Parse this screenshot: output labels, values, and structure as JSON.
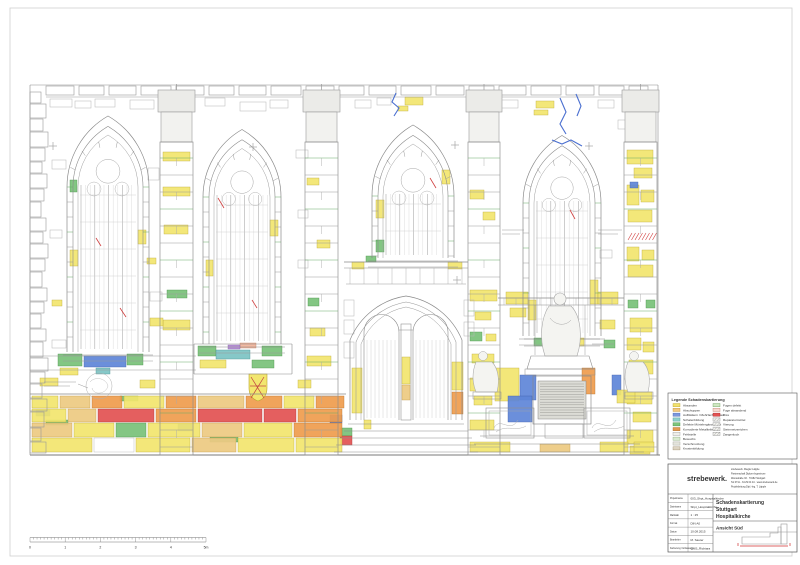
{
  "sheet": {
    "background": "#ffffff",
    "border_color": "#c9c9c9"
  },
  "legend": {
    "title": "Legende Schadenskartierung",
    "columns": [
      {
        "items": [
          {
            "label": "Absanden",
            "color": "#f1e26e",
            "outline": "#b9a42e"
          },
          {
            "label": "Abschuppen",
            "color": "#f3c97e",
            "outline": "#bf9440"
          },
          {
            "label": "Aufblättern / Mehrfachschalen",
            "color": "#7b97dc",
            "outline": "#4a66b0"
          },
          {
            "label": "Schalenbildung",
            "color": "#8fd0cc",
            "outline": "#4a9a96"
          },
          {
            "label": "Defekte Mörtelergänzungen",
            "color": "#7cc47c",
            "outline": "#3f8f3f"
          },
          {
            "label": "Korrodierte Metallteile",
            "color": "#e29a50",
            "outline": "#a86a28"
          },
          {
            "label": "Fehlstelle",
            "color": "#efefe9",
            "outline": "#999999"
          },
          {
            "label": "Bewuchs",
            "color": "#d9ead0",
            "outline": "#8aa87a"
          },
          {
            "label": "Verschmutzung",
            "color": "#e4e4dc",
            "outline": "#a0a095"
          },
          {
            "label": "Krustenbildung",
            "color": "#ddd4c2",
            "outline": "#a09070"
          }
        ]
      },
      {
        "items": [
          {
            "label": "Fugen defekt",
            "color": "#cfe7c2",
            "outline": "#6aa05a"
          },
          {
            "label": "Fuge absandend",
            "color": "#f6d9cf",
            "outline": "#c08070"
          },
          {
            "label": "Riss",
            "color": "#e25252",
            "outline": "#a82828"
          },
          {
            "label": "Reparaturmörtel",
            "color": "#f2f2ee",
            "outline": "#888888",
            "hatch": true
          },
          {
            "label": "Vierung",
            "color": "#f2f2ee",
            "outline": "#888888",
            "hatch": true
          },
          {
            "label": "Steinmetzzeichen",
            "color": "#f2f2ee",
            "outline": "#888888",
            "hatch": true
          },
          {
            "label": "Zangenloch",
            "color": "#f2f2ee",
            "outline": "#888888",
            "hatch": true
          }
        ]
      }
    ]
  },
  "title_block": {
    "logo": "strebewerk.",
    "logo_color": "#c41828",
    "address_lines": [
      "strebewerk. Riegler Läpple",
      "Partnerschaft Diplom-Ingenieure",
      "Werastraße 33 · 70182 Stuttgart",
      "Tel 0711 - 34 29 04 44 · www.strebewerk.de",
      "Projektleitung Dipl.-Ing. T. Läpple"
    ],
    "fields": [
      {
        "label": "Projektname",
        "value": "003_Shpt_Hospitalkirche"
      },
      {
        "label": "Dateiname",
        "value": "Shpt_Hospitalkirche"
      },
      {
        "label": "Maßstab",
        "value": "1 : 25"
      },
      {
        "label": "Format",
        "value": "DIN A0"
      },
      {
        "label": "Datum",
        "value": "10.08.2015"
      },
      {
        "label": "Bearbeiter",
        "value": "M. Sauter"
      },
      {
        "label": "Kartierung / Erfassung",
        "value": "QMS_Richtara"
      }
    ],
    "project_title_lines": [
      "Schadenskartierung",
      "Stuttgart",
      "Hospitalkirche"
    ],
    "view_label": "Ansicht Süd"
  },
  "scale_bar": {
    "labels": [
      "0",
      "1",
      "2",
      "3",
      "4",
      "5m"
    ]
  },
  "drawing": {
    "palette": {
      "Y": "#f2e66e",
      "T": "#edca82",
      "O": "#ef9d4e",
      "R": "#e25252",
      "G": "#79c279",
      "B": "#5f86d8",
      "C": "#7cc4c4",
      "W": "#ffffff",
      "S": "#f2b49a",
      "P": "#b58cd6"
    },
    "outlines": {
      "Y": "#b9a42e",
      "T": "#bf9440",
      "O": "#b56a20",
      "R": "#a82828",
      "G": "#3f8f3f",
      "B": "#3a5aa8",
      "C": "#3f908f",
      "W": "#aaaaaa",
      "S": "#c07858",
      "P": "#7e55a8"
    },
    "patches": [
      [
        405,
        97,
        18,
        8,
        "Y"
      ],
      [
        398,
        106,
        10,
        5,
        "Y"
      ],
      [
        536,
        101,
        18,
        7,
        "Y"
      ],
      [
        534,
        110,
        14,
        5,
        "Y"
      ],
      [
        163,
        152,
        27,
        9,
        "Y"
      ],
      [
        163,
        187,
        27,
        9,
        "Y"
      ],
      [
        164,
        225,
        24,
        9,
        "Y"
      ],
      [
        167,
        290,
        20,
        8,
        "G"
      ],
      [
        163,
        320,
        27,
        10,
        "Y"
      ],
      [
        307,
        178,
        12,
        7,
        "Y"
      ],
      [
        317,
        240,
        13,
        8,
        "Y"
      ],
      [
        308,
        298,
        11,
        8,
        "G"
      ],
      [
        310,
        328,
        15,
        8,
        "Y"
      ],
      [
        307,
        356,
        24,
        10,
        "Y"
      ],
      [
        470,
        190,
        14,
        9,
        "Y"
      ],
      [
        483,
        212,
        12,
        8,
        "Y"
      ],
      [
        470,
        290,
        27,
        11,
        "Y"
      ],
      [
        475,
        312,
        16,
        8,
        "Y"
      ],
      [
        470,
        332,
        12,
        9,
        "G"
      ],
      [
        486,
        334,
        10,
        7,
        "Y"
      ],
      [
        472,
        354,
        22,
        9,
        "Y"
      ],
      [
        470,
        378,
        27,
        13,
        "Y"
      ],
      [
        474,
        396,
        18,
        9,
        "Y"
      ],
      [
        470,
        420,
        24,
        10,
        "Y"
      ],
      [
        627,
        150,
        26,
        14,
        "Y"
      ],
      [
        634,
        168,
        18,
        10,
        "Y"
      ],
      [
        627,
        185,
        12,
        20,
        "Y"
      ],
      [
        641,
        190,
        13,
        12,
        "Y"
      ],
      [
        628,
        210,
        24,
        12,
        "Y"
      ],
      [
        630,
        182,
        8,
        6,
        "B"
      ],
      [
        627,
        247,
        12,
        14,
        "Y"
      ],
      [
        642,
        250,
        12,
        10,
        "Y"
      ],
      [
        628,
        265,
        25,
        12,
        "Y"
      ],
      [
        646,
        300,
        9,
        8,
        "G"
      ],
      [
        628,
        300,
        10,
        8,
        "G"
      ],
      [
        630,
        318,
        22,
        14,
        "Y"
      ],
      [
        627,
        338,
        14,
        12,
        "Y"
      ],
      [
        643,
        342,
        11,
        10,
        "Y"
      ],
      [
        629,
        360,
        24,
        14,
        "Y"
      ],
      [
        627,
        392,
        25,
        12,
        "Y"
      ],
      [
        633,
        412,
        18,
        10,
        "Y"
      ],
      [
        627,
        430,
        26,
        14,
        "Y"
      ],
      [
        630,
        446,
        20,
        8,
        "Y"
      ],
      [
        70,
        250,
        8,
        16,
        "Y"
      ],
      [
        138,
        230,
        8,
        14,
        "Y"
      ],
      [
        70,
        180,
        7,
        12,
        "G"
      ],
      [
        206,
        260,
        7,
        16,
        "Y"
      ],
      [
        270,
        220,
        8,
        16,
        "Y"
      ],
      [
        376,
        200,
        8,
        18,
        "Y"
      ],
      [
        442,
        170,
        8,
        14,
        "Y"
      ],
      [
        376,
        240,
        8,
        12,
        "G"
      ],
      [
        528,
        300,
        8,
        20,
        "Y"
      ],
      [
        590,
        280,
        8,
        24,
        "Y"
      ],
      [
        58,
        354,
        24,
        12,
        "G"
      ],
      [
        84,
        356,
        42,
        11,
        "B"
      ],
      [
        127,
        354,
        16,
        11,
        "G"
      ],
      [
        60,
        368,
        18,
        7,
        "Y"
      ],
      [
        96,
        368,
        14,
        6,
        "C"
      ],
      [
        198,
        346,
        18,
        10,
        "G"
      ],
      [
        216,
        350,
        34,
        9,
        "C"
      ],
      [
        262,
        346,
        20,
        10,
        "G"
      ],
      [
        200,
        360,
        26,
        8,
        "Y"
      ],
      [
        252,
        360,
        22,
        8,
        "G"
      ],
      [
        240,
        343,
        16,
        5,
        "S"
      ],
      [
        228,
        345,
        12,
        4,
        "P"
      ],
      [
        534,
        338,
        18,
        8,
        "G"
      ],
      [
        566,
        338,
        18,
        8,
        "Y"
      ],
      [
        352,
        262,
        12,
        7,
        "Y"
      ],
      [
        448,
        262,
        14,
        7,
        "Y"
      ],
      [
        366,
        256,
        10,
        6,
        "G"
      ],
      [
        352,
        368,
        10,
        45,
        "Y"
      ],
      [
        452,
        362,
        11,
        28,
        "Y"
      ],
      [
        452,
        392,
        11,
        22,
        "O"
      ],
      [
        340,
        428,
        12,
        8,
        "G"
      ],
      [
        340,
        436,
        12,
        9,
        "R"
      ],
      [
        402,
        357,
        8,
        27,
        "Y"
      ],
      [
        402,
        385,
        8,
        15,
        "T"
      ],
      [
        364,
        420,
        7,
        9,
        "Y"
      ],
      [
        506,
        292,
        22,
        12,
        "Y"
      ],
      [
        510,
        308,
        16,
        9,
        "Y"
      ],
      [
        495,
        368,
        24,
        33,
        "Y"
      ],
      [
        520,
        375,
        16,
        25,
        "B"
      ],
      [
        508,
        396,
        24,
        26,
        "B"
      ],
      [
        582,
        368,
        13,
        26,
        "O"
      ],
      [
        612,
        375,
        9,
        20,
        "B"
      ],
      [
        598,
        292,
        20,
        12,
        "Y"
      ],
      [
        600,
        320,
        15,
        9,
        "Y"
      ],
      [
        604,
        340,
        11,
        8,
        "G"
      ],
      [
        617,
        390,
        18,
        13,
        "Y"
      ],
      [
        150,
        318,
        13,
        8,
        "Y"
      ],
      [
        52,
        300,
        10,
        6,
        "Y"
      ],
      [
        147,
        258,
        9,
        6,
        "Y"
      ],
      [
        40,
        378,
        18,
        8,
        "Y"
      ],
      [
        140,
        380,
        15,
        8,
        "Y"
      ],
      [
        298,
        380,
        13,
        8,
        "Y"
      ],
      [
        330,
        415,
        12,
        8,
        "B"
      ],
      [
        36,
        410,
        14,
        6,
        "B"
      ],
      [
        178,
        424,
        14,
        7,
        "B"
      ],
      [
        46,
        420,
        22,
        5,
        "G"
      ],
      [
        210,
        437,
        28,
        5,
        "G"
      ],
      [
        120,
        396,
        18,
        5,
        "G"
      ],
      [
        32,
        396,
        26,
        12,
        "Y"
      ],
      [
        60,
        396,
        30,
        12,
        "T"
      ],
      [
        92,
        396,
        30,
        12,
        "O"
      ],
      [
        124,
        396,
        40,
        12,
        "Y"
      ],
      [
        166,
        396,
        30,
        12,
        "O"
      ],
      [
        198,
        396,
        46,
        12,
        "T"
      ],
      [
        246,
        396,
        36,
        12,
        "O"
      ],
      [
        284,
        396,
        30,
        12,
        "Y"
      ],
      [
        316,
        396,
        28,
        12,
        "O"
      ],
      [
        32,
        409,
        34,
        13,
        "Y"
      ],
      [
        68,
        409,
        28,
        13,
        "T"
      ],
      [
        98,
        409,
        56,
        13,
        "R"
      ],
      [
        156,
        409,
        40,
        13,
        "O"
      ],
      [
        198,
        409,
        64,
        13,
        "R"
      ],
      [
        264,
        409,
        32,
        13,
        "R"
      ],
      [
        298,
        409,
        44,
        13,
        "O"
      ],
      [
        32,
        423,
        40,
        14,
        "T"
      ],
      [
        74,
        423,
        40,
        14,
        "Y"
      ],
      [
        116,
        423,
        30,
        14,
        "G"
      ],
      [
        148,
        423,
        52,
        14,
        "Y"
      ],
      [
        202,
        423,
        40,
        14,
        "T"
      ],
      [
        244,
        423,
        48,
        14,
        "Y"
      ],
      [
        294,
        423,
        48,
        14,
        "O"
      ],
      [
        32,
        438,
        60,
        14,
        "Y"
      ],
      [
        94,
        438,
        40,
        14,
        "W"
      ],
      [
        136,
        438,
        54,
        14,
        "Y"
      ],
      [
        192,
        438,
        44,
        14,
        "T"
      ],
      [
        238,
        438,
        56,
        14,
        "Y"
      ],
      [
        296,
        438,
        46,
        14,
        "Y"
      ],
      [
        470,
        442,
        40,
        10,
        "Y"
      ],
      [
        540,
        444,
        30,
        8,
        "T"
      ],
      [
        600,
        442,
        28,
        10,
        "Y"
      ],
      [
        634,
        442,
        20,
        10,
        "Y"
      ]
    ],
    "cracks_blue": [
      [
        396,
        93,
        392,
        102,
        399,
        108,
        394,
        116
      ],
      [
        560,
        98,
        566,
        112,
        560,
        124,
        566,
        134
      ],
      [
        576,
        94,
        581,
        106,
        577,
        116
      ],
      [
        552,
        140,
        562,
        144,
        571,
        140,
        582,
        146
      ]
    ],
    "cracks_red": [
      [
        96,
        238,
        101,
        246
      ],
      [
        218,
        198,
        224,
        208
      ],
      [
        430,
        178,
        436,
        188
      ],
      [
        570,
        210,
        575,
        219
      ],
      [
        120,
        308,
        126,
        317
      ],
      [
        252,
        300,
        257,
        308
      ]
    ],
    "crosses": [
      [
        53,
        146
      ],
      [
        253,
        147
      ],
      [
        455,
        145
      ],
      [
        589,
        146
      ],
      [
        457,
        280
      ]
    ]
  }
}
